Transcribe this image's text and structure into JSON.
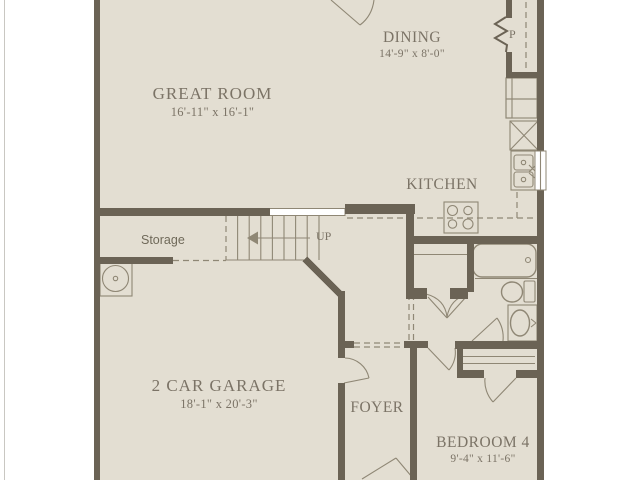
{
  "rooms": {
    "great_room": {
      "label": "GREAT ROOM",
      "dims": "16'-11\" x 16'-1\""
    },
    "dining": {
      "label": "DINING",
      "dims": "14'-9\" x 8'-0\""
    },
    "kitchen": {
      "label": "KITCHEN"
    },
    "garage": {
      "label": "2 CAR GARAGE",
      "dims": "18'-1\" x 20'-3\""
    },
    "foyer": {
      "label": "FOYER"
    },
    "bedroom4": {
      "label": "BEDROOM 4",
      "dims": "9'-4\" x 11'-6\""
    }
  },
  "annotations": {
    "storage": "Storage",
    "stairs_direction": "UP",
    "pantry": "P"
  },
  "colors": {
    "wall": "#6b6355",
    "thin": "#8f8775",
    "floor": "#e3ded2",
    "label": "#7b7366"
  }
}
